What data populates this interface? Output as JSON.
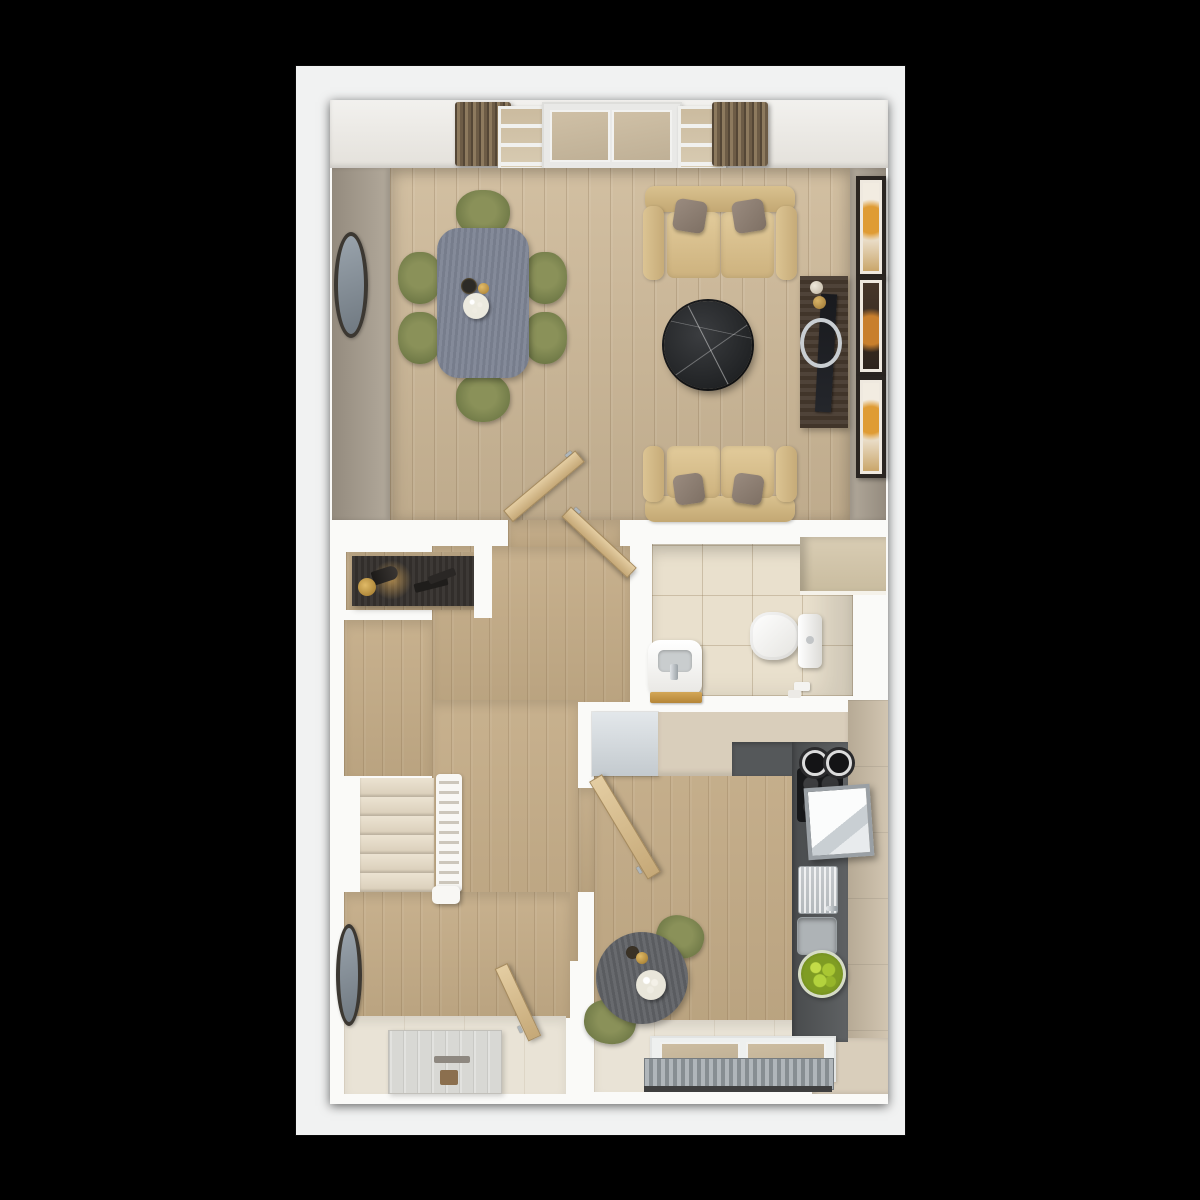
{
  "image": {
    "type": "3d-floorplan-render",
    "description": "Top-down 3D render of a ground-floor home: open-plan living/dining room with french doors at top, central hallway with staircase, WC, kitchen with breakfast table, entrance hall with front door. No visible text in the image.",
    "visible_text": ""
  },
  "canvas": {
    "background": "#000000",
    "sheet": "#f1f2f2",
    "wall": "#fafaf8"
  },
  "palette": {
    "wall_taupe": "#a79e92",
    "wood_living": "#cdb897",
    "wood_hall": "#c4ac87",
    "tile_wc": "#e9e0cd",
    "floor_cream": "#e9e3d6",
    "counter_dark": "#55585a",
    "cabinet_beige": "#d9cebb",
    "cabinet_tan": "#cbbda6",
    "fridge_grey": "#d4dbe0",
    "sofa_tan": "#d8bf8f",
    "pillow_grey": "#8d7e73",
    "chair_green": "#76804f",
    "dining_table_slate": "#7d8494",
    "round_table_grey": "#606266",
    "marble_black": "#26282a",
    "console_dark": "#35312e",
    "tv_unit_brown": "#46392e",
    "door_tan": "#d2b88e",
    "curtain_brown": "#8a775c",
    "steps_cream": "#e2d8c6",
    "radiator_grey": "#9aa1a5",
    "apples_green": "#9fc02c",
    "art_orange": "#d8922e",
    "hob_black": "#17181a",
    "front_door_grey": "#d8d8d4"
  },
  "rooms": [
    {
      "name": "living-dining-room",
      "floor": "light oak planks",
      "features": [
        "french-doors",
        "two side windows",
        "two brown curtains",
        "round wall mirror",
        "dining table",
        "6 green chairs",
        "table centerpiece (vase, gold ball, white plate)",
        "two tan sofas with grey pillows",
        "black marble coffee table",
        "dark tv unit with tv and silver ring",
        "3 framed artworks on right wall"
      ]
    },
    {
      "name": "hallway",
      "floor": "oak planks",
      "features": [
        "dark console table with cone lamp, brass dish and remotes",
        "open door to living room",
        "open door to wc",
        "open door to kitchen"
      ]
    },
    {
      "name": "wc",
      "floor": "beige ceramic tiles",
      "features": [
        "white basin with chrome tap and wooden tray",
        "toilet with cistern",
        "boxed duct shelf",
        "toilet paper rolls"
      ]
    },
    {
      "name": "kitchen",
      "floor": "oak planks and cream tiles",
      "features": [
        "grey fridge",
        "beige worktop",
        "dark grey counter run",
        "black hob with two pots",
        "extractor hood",
        "stainless sink with drainer",
        "glass bowl of green apples",
        "tan tall cabinets",
        "window with radiator",
        "round bistro table with candle and flowers",
        "2 green chairs"
      ]
    },
    {
      "name": "stairs",
      "features": [
        "6 visible cream steps",
        "white balustrade",
        "newel post"
      ]
    },
    {
      "name": "entrance-hall",
      "features": [
        "white front door with letterbox",
        "oval wall mirror",
        "cream threshold"
      ]
    }
  ]
}
